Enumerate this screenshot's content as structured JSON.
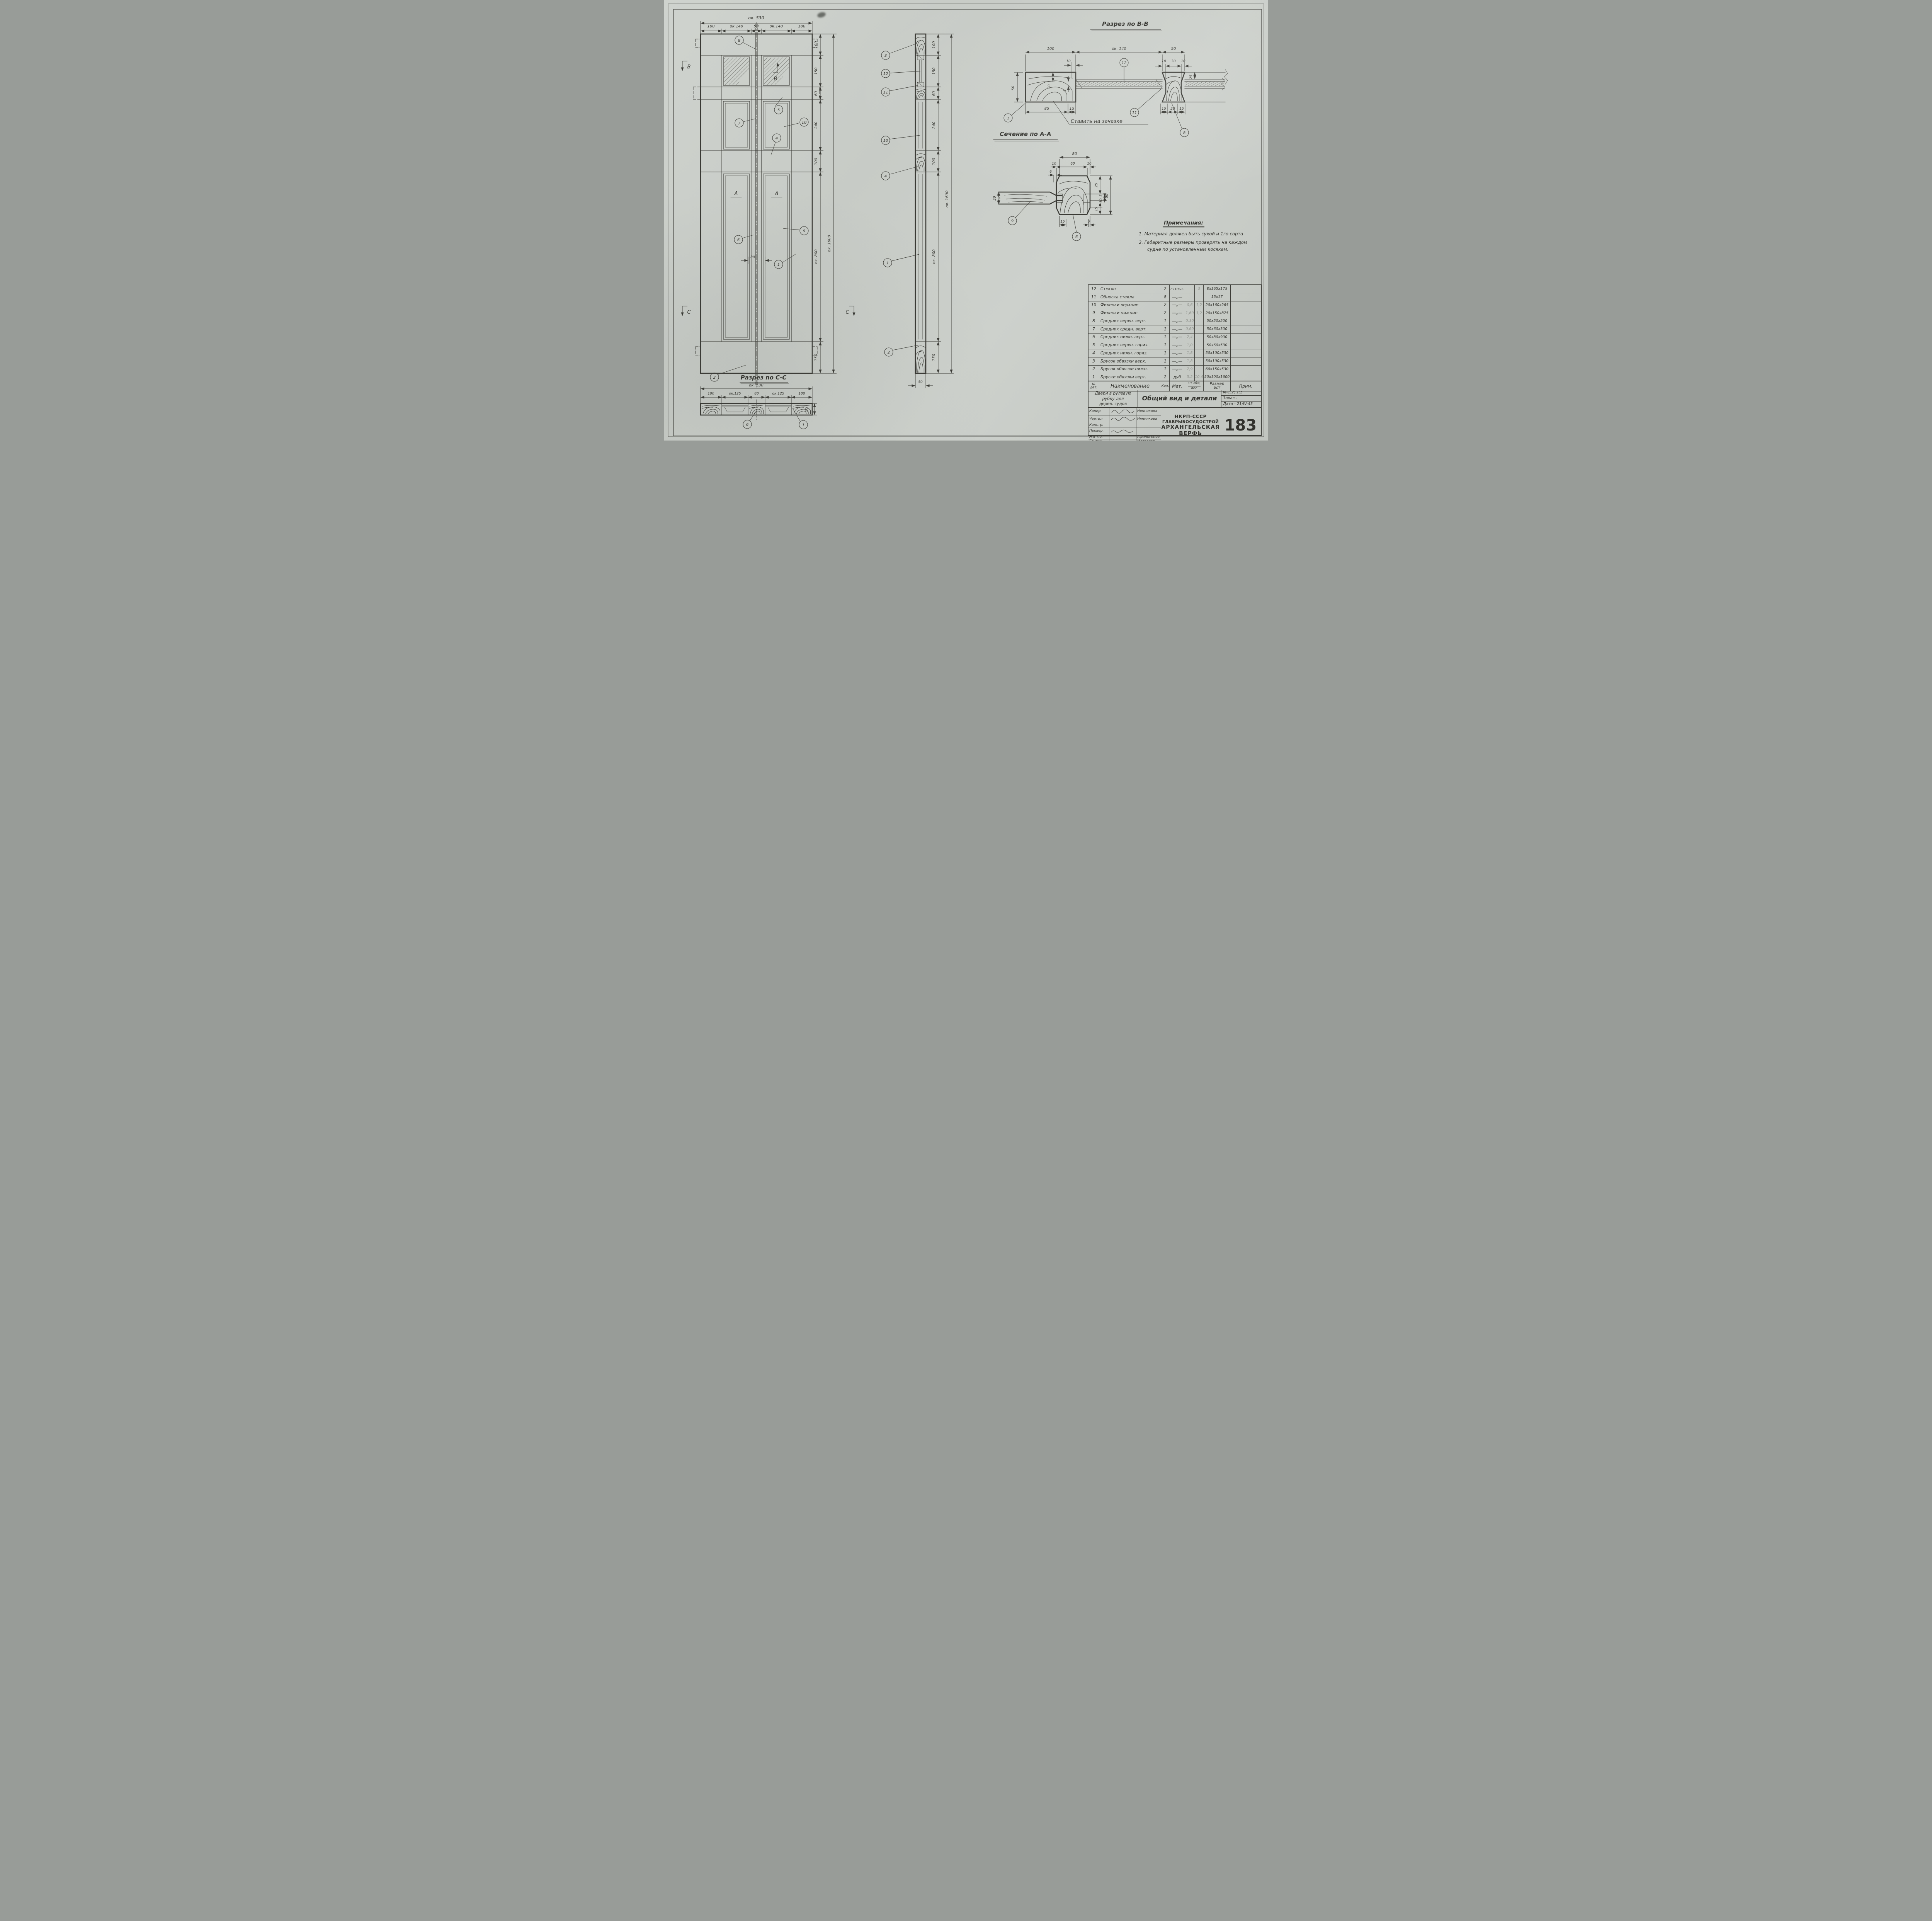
{
  "colors": {
    "paper": "#c9cdc8",
    "ink": "#3a3a35",
    "pencil": "#8f928c"
  },
  "front_elevation": {
    "dim_total_width": "ок. 530",
    "dims_top": [
      "100",
      "ок.140",
      "50",
      "ок.140",
      "100"
    ],
    "dims_right": [
      "100",
      "150",
      "60",
      "240",
      "100",
      "ок. 800",
      "150"
    ],
    "dim_total_height": "ок. 1600",
    "dim_meeting": "80",
    "label_a_left": "А",
    "label_a_right": "А",
    "mark_b_left": "В",
    "mark_b_pane": "В",
    "mark_c_left": "С",
    "mark_c_right": "С",
    "callouts": {
      "c8": "8",
      "c5": "5",
      "c7": "7",
      "c10": "10",
      "c4": "4",
      "c6": "6",
      "c9": "9",
      "c1": "1",
      "c2": "2"
    }
  },
  "side_view": {
    "dims_right": [
      "100",
      "150",
      "60",
      "240",
      "100",
      "ок. 800",
      "150"
    ],
    "dim_total_height": "ок. 1600",
    "dim_thickness": "50",
    "callouts": {
      "c3": "3",
      "c12": "12",
      "c11": "11",
      "c10": "10",
      "c4": "4",
      "c1": "1",
      "c2": "2"
    }
  },
  "section_bb": {
    "title": "Разрез по В-В",
    "dims_top": [
      "100",
      "ок. 140",
      "50"
    ],
    "dim_10": "10",
    "dims_stile_top": [
      "10",
      "30",
      "10"
    ],
    "dim_height": "50",
    "dim_20": "20",
    "dim_8": "8",
    "dim_25": "25",
    "dims_bottom_left": [
      "85",
      "15"
    ],
    "dims_bottom_right": [
      "15",
      "20",
      "15"
    ],
    "note": "Ставить на зачазке",
    "callouts": {
      "c12": "12",
      "c1": "1",
      "c11": "11",
      "c8": "8"
    }
  },
  "section_aa": {
    "title": "Сечение по А-А",
    "dim_80": "80",
    "dims_top": [
      "10",
      "60",
      "10"
    ],
    "dim_6": "6",
    "dim_left": "20",
    "dims_right": [
      "25",
      "5",
      "10",
      "15",
      "50"
    ],
    "dims_bottom": [
      "15",
      "7"
    ],
    "callouts": {
      "c9": "9",
      "c6": "6"
    }
  },
  "section_cc": {
    "title": "Разрез по С-С",
    "dim_total_width": "ок. 530",
    "dims": [
      "100",
      "ок.125",
      "80",
      "ок.125",
      "100"
    ],
    "dim_height": "50",
    "callouts": {
      "c6": "6",
      "c1": "1"
    }
  },
  "notes": {
    "heading": "Примечания:",
    "line1": "1. Материал должен быть сухой и 1го сорта",
    "line2": "2. Габаритные размеры проверять на каждом",
    "line3": "судне по установленным косякам."
  },
  "parts_table": {
    "headers": {
      "num": "№",
      "num2": "дет.",
      "name": "Наименование",
      "qty": "Кол.",
      "mat": "Мат.",
      "w_pc": "шт.",
      "w_tot": "общ.",
      "w": "вес",
      "size": "Размер",
      "size2": "вст",
      "note": "Прим."
    },
    "rows": [
      {
        "num": "12",
        "name": "Стекло",
        "qty": "2",
        "mat": "стекл.",
        "wpc": "",
        "wtot": "3",
        "size": "8х165х175"
      },
      {
        "num": "11",
        "name": "Обноска стекла",
        "qty": "8",
        "mat": "—„—",
        "wpc": "",
        "wtot": "",
        "size": "15х17"
      },
      {
        "num": "10",
        "name": "Филенки верхние",
        "qty": "2",
        "mat": "—„—",
        "wpc": "0,6",
        "wtot": "1,2",
        "size": "20х160х265"
      },
      {
        "num": "9",
        "name": "Филенки нижние",
        "qty": "2",
        "mat": "—„—",
        "wpc": "1,60",
        "wtot": "3,2",
        "size": "20х150х825"
      },
      {
        "num": "8",
        "name": "Средник верхн. верт.",
        "qty": "1",
        "mat": "—„—",
        "wpc": "0,30",
        "wtot": "",
        "size": "50х50х200"
      },
      {
        "num": "7",
        "name": "Средник средн. верт.",
        "qty": "1",
        "mat": "—„—",
        "wpc": "0,60",
        "wtot": "",
        "size": "50х60х300"
      },
      {
        "num": "6",
        "name": "Средник нижн. верт.",
        "qty": "1",
        "mat": "—„—",
        "wpc": "2,4",
        "wtot": "",
        "size": "50х80х900"
      },
      {
        "num": "5",
        "name": "Средник верхн. гориз.",
        "qty": "1",
        "mat": "—„—",
        "wpc": "1,0",
        "wtot": "",
        "size": "50х60х530"
      },
      {
        "num": "4",
        "name": "Средник нижн. гориз.",
        "qty": "1",
        "mat": "—„—",
        "wpc": "1,8",
        "wtot": "",
        "size": "50х100х530"
      },
      {
        "num": "3",
        "name": "Брусок обвязки верх.",
        "qty": "1",
        "mat": "—„—",
        "wpc": "1,8",
        "wtot": "",
        "size": "50х100х530"
      },
      {
        "num": "2",
        "name": "Брусок обвязки нижн.",
        "qty": "1",
        "mat": "—„—",
        "wpc": "2,9",
        "wtot": "",
        "size": "60х150х530"
      },
      {
        "num": "1",
        "name": "Бруски обвязки верт.",
        "qty": "2",
        "mat": "дуб",
        "wpc": "5,2",
        "wtot": "10,4",
        "size": "50х100х1600"
      }
    ]
  },
  "title_block": {
    "project1": "Двери в рулевую",
    "project2": "рубку для",
    "project3": "дерев. судов",
    "sheet_title": "Общий вид и детали",
    "scale": "М-1:2; 1:5",
    "order": "Заказ -",
    "date": "Дата - 21/IV-43",
    "rows": [
      {
        "label": "Копир.",
        "name": "Нянникова"
      },
      {
        "label": "Чертил",
        "name": "Нянникова"
      },
      {
        "label": "Констр.",
        "name": ""
      },
      {
        "label": "Провер.",
        "name": ""
      },
      {
        "label": "Н-к т.о.",
        "name": "Афиногенов"
      },
      {
        "label": "Гл.инж.",
        "name": "Матросов"
      }
    ],
    "org1": "НКРП-СССР",
    "org2": "ГЛАВРЫБОСУДОСТРОЙ",
    "org3": "АРХАНГЕЛЬСКАЯ",
    "org4": "ВЕРФЬ",
    "number": "183"
  }
}
